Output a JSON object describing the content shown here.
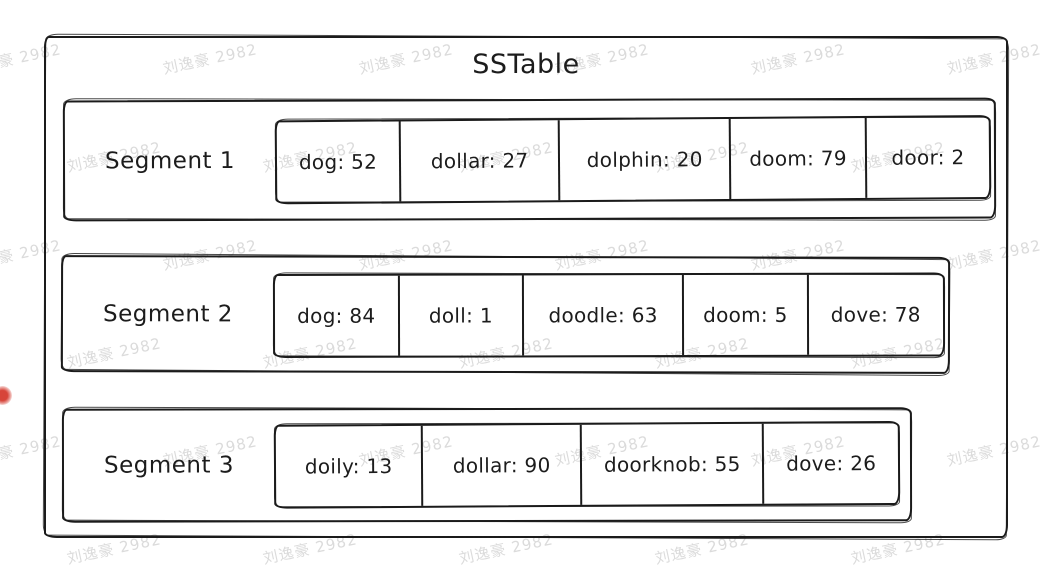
{
  "title": "SSTable",
  "watermark": {
    "text": "刘逸豪 2982",
    "color": "#d5d5d5"
  },
  "pointer": {
    "color": "#d7453a"
  },
  "segments": [
    {
      "label": "Segment 1",
      "entries": [
        {
          "key": "dog",
          "value": 52
        },
        {
          "key": "dollar",
          "value": 27
        },
        {
          "key": "dolphin",
          "value": 20
        },
        {
          "key": "doom",
          "value": 79
        },
        {
          "key": "door",
          "value": 2
        }
      ]
    },
    {
      "label": "Segment 2",
      "entries": [
        {
          "key": "dog",
          "value": 84
        },
        {
          "key": "doll",
          "value": 1
        },
        {
          "key": "doodle",
          "value": 63
        },
        {
          "key": "doom",
          "value": 5
        },
        {
          "key": "dove",
          "value": 78
        }
      ]
    },
    {
      "label": "Segment 3",
      "entries": [
        {
          "key": "doily",
          "value": 13
        },
        {
          "key": "dollar",
          "value": 90
        },
        {
          "key": "doorknob",
          "value": 55
        },
        {
          "key": "dove",
          "value": 26
        }
      ]
    }
  ]
}
